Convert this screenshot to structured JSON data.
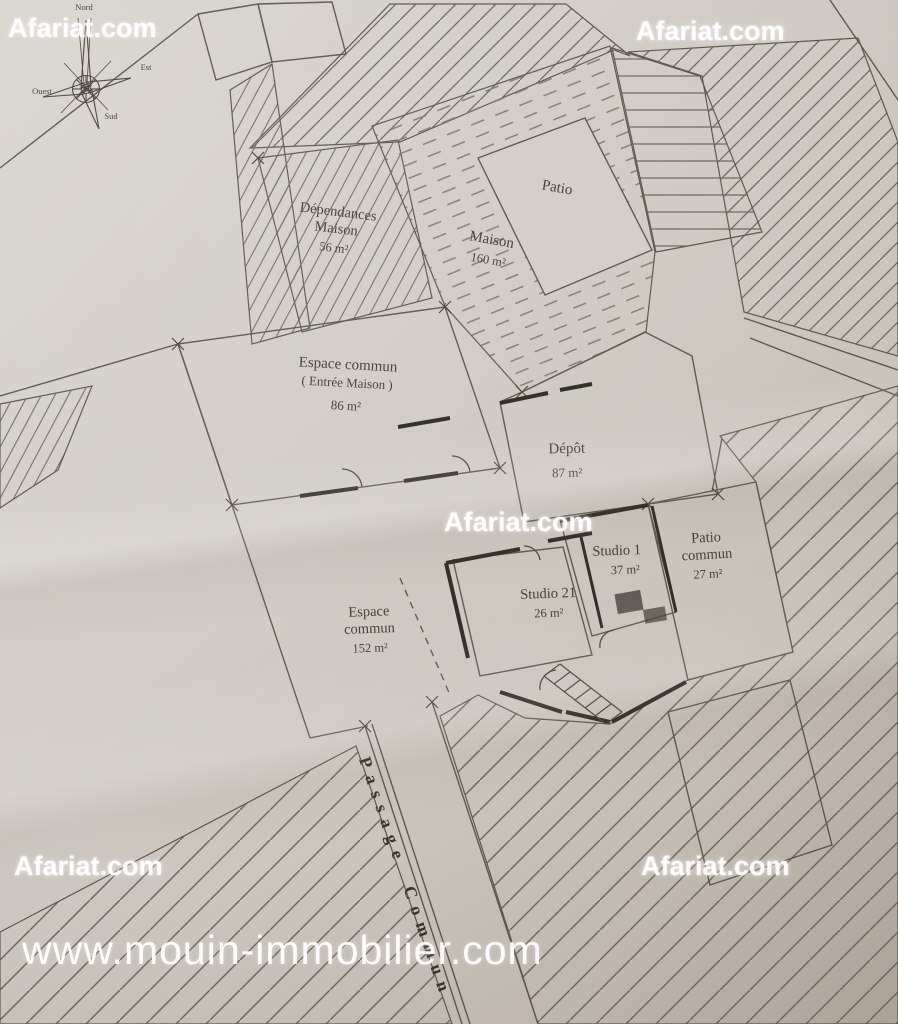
{
  "watermarks": {
    "brand": "Afariat.com",
    "site": "www.mouin-immobilier.com"
  },
  "compass": {
    "north": "Nord",
    "east": "Est",
    "west": "Ouest",
    "south": "Sud"
  },
  "rooms": {
    "dependances": {
      "name_line1": "Dépendances",
      "name_line2": "Maison",
      "area": "56 m²"
    },
    "maison": {
      "name": "Maison",
      "area": "160 m²"
    },
    "patio": {
      "name": "Patio"
    },
    "espace_commun_86": {
      "name": "Espace commun",
      "subtitle": "( Entrée Maison )",
      "area": "86 m²"
    },
    "depot": {
      "name": "Dépôt",
      "area": "87 m²"
    },
    "studio_1": {
      "name": "Studio 1",
      "area": "37 m²"
    },
    "patio_commun": {
      "name_line1": "Patio",
      "name_line2": "commun",
      "area": "27 m²"
    },
    "studio_21": {
      "name": "Studio 21",
      "area": "26 m²"
    },
    "espace_commun_152": {
      "name_line1": "Espace",
      "name_line2": "commun",
      "area": "152 m²"
    },
    "passage_commun": {
      "name": "Passage Commun"
    }
  },
  "colors": {
    "paper": "#d4cfc8",
    "paper_dark": "#bdb5ab",
    "plan_line": "#5e584e",
    "wall": "#302c26",
    "hatch": "#6f6a60",
    "label_text": "#433e36",
    "watermark_text": "#ffffff"
  }
}
